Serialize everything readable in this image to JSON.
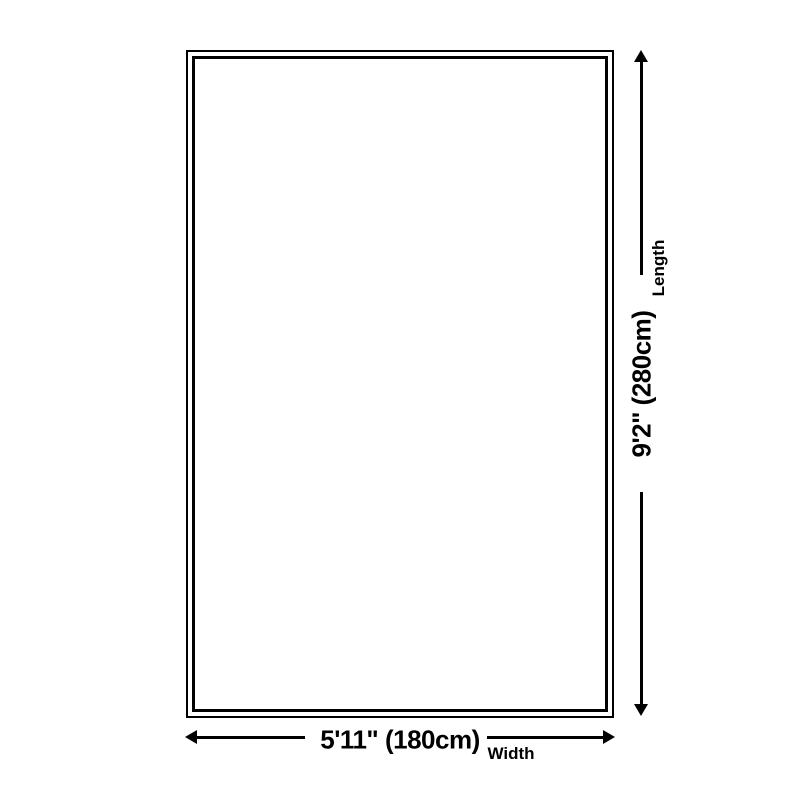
{
  "diagram": {
    "type": "product-size-diagram",
    "colors": {
      "background": "#ffffff",
      "line": "#000000"
    },
    "dimensions": {
      "length": {
        "value": "9'2\" (280cm)",
        "label": "Length"
      },
      "width": {
        "value": "5'11\" (180cm)",
        "label": "Width"
      }
    }
  }
}
